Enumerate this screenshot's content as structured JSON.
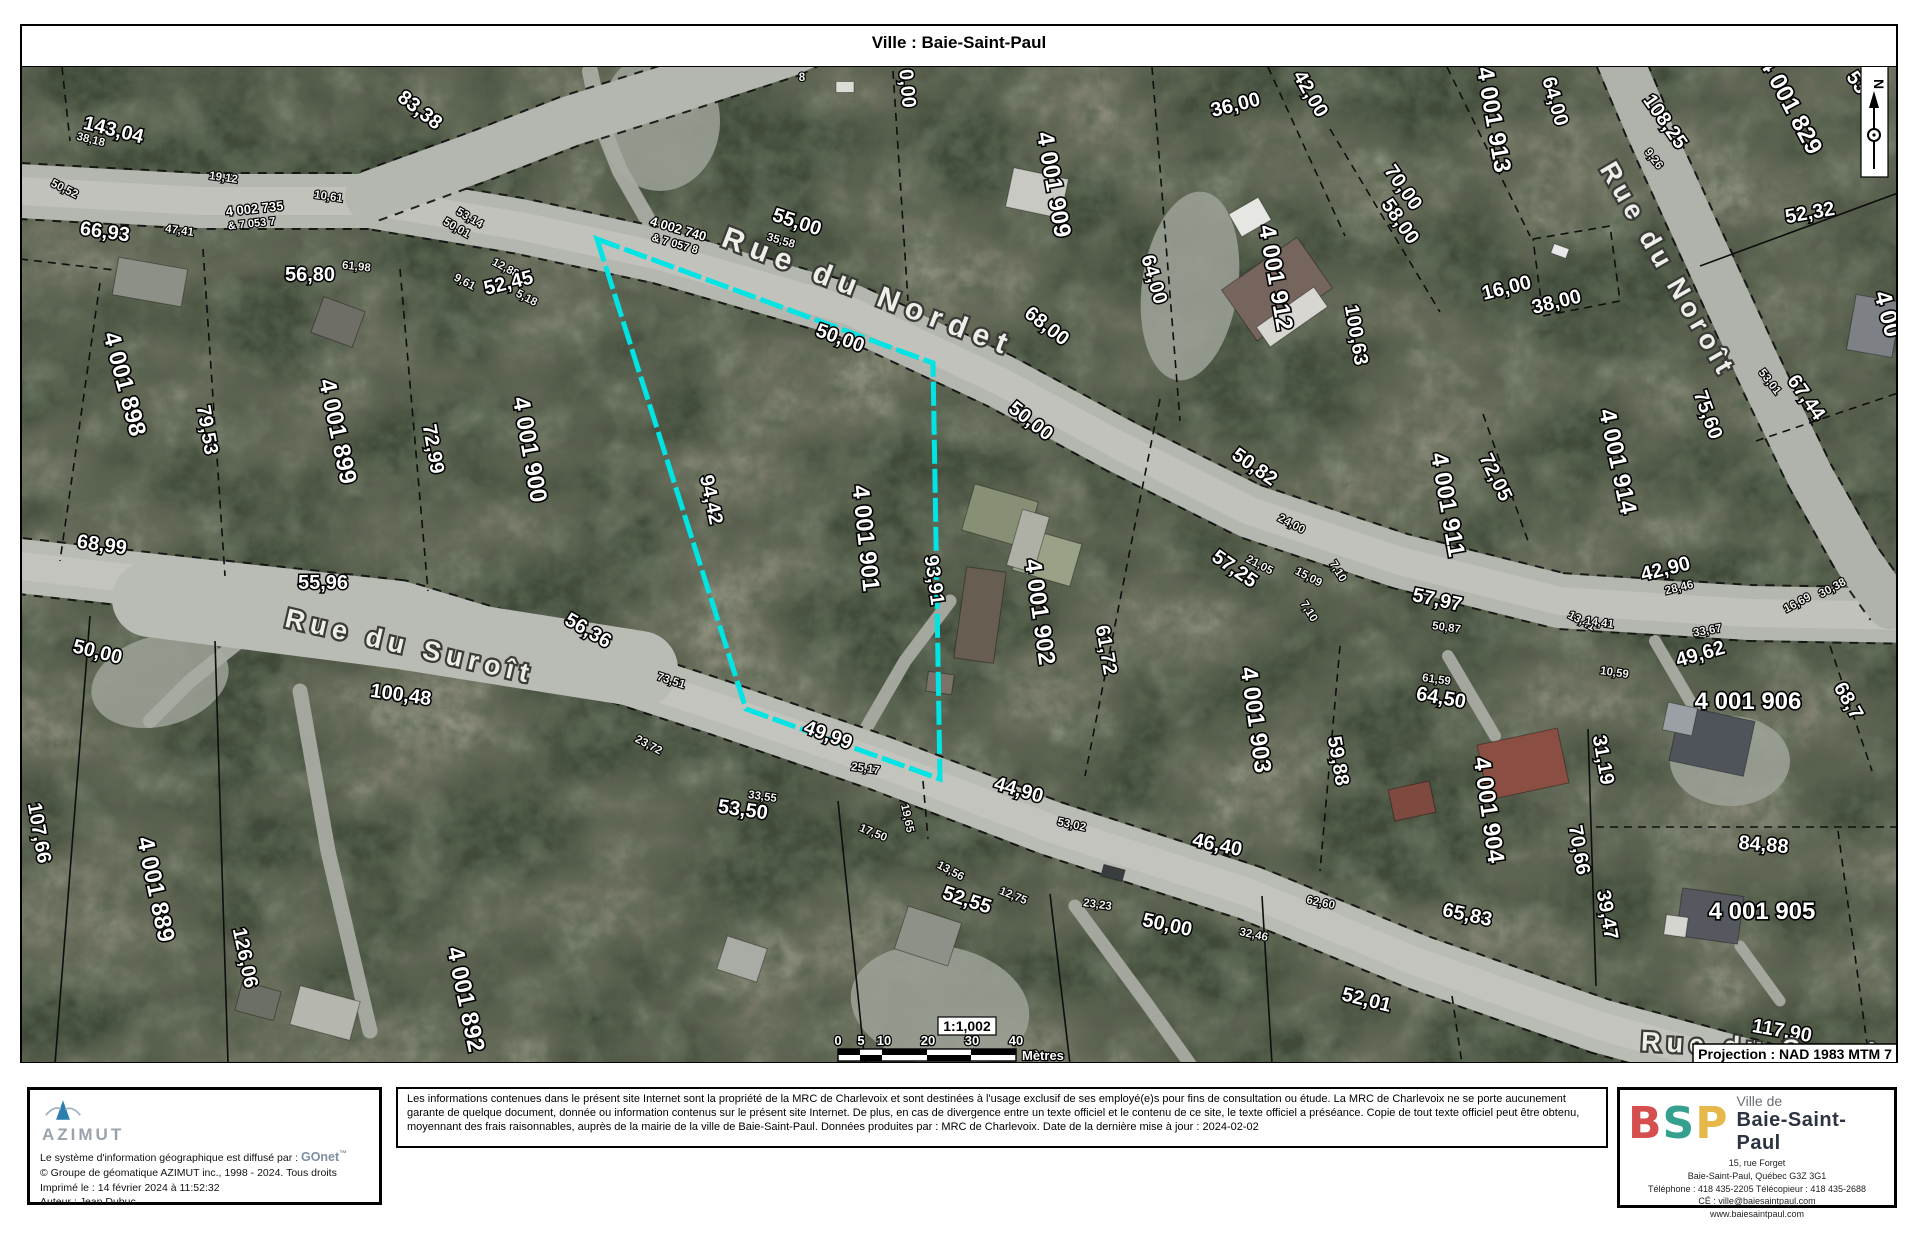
{
  "title": "Ville : Baie-Saint-Paul",
  "map": {
    "projection": "Projection : NAD 1983 MTM 7",
    "north_label": "N",
    "highlight_color": "#00e4e4",
    "parcel": "597,238 933,362 940,778 746,708",
    "scale": {
      "ratio": "1:1,002",
      "unit": "Mètres",
      "ticks": [
        {
          "t": "0",
          "x": 838
        },
        {
          "t": "5",
          "x": 861
        },
        {
          "t": "10",
          "x": 884
        },
        {
          "t": "20",
          "x": 928
        },
        {
          "t": "30",
          "x": 972
        },
        {
          "t": "40",
          "x": 1016
        }
      ],
      "seg": [
        [
          838,
          860
        ],
        [
          860,
          882
        ],
        [
          882,
          927
        ],
        [
          927,
          971
        ],
        [
          971,
          1016
        ]
      ]
    },
    "streets": [
      [
        "Rue du Nordet",
        865,
        300,
        21,
        30,
        8
      ],
      [
        "Rue du Suroît",
        408,
        654,
        13,
        27,
        6
      ],
      [
        "Rue du Noroît",
        1660,
        273,
        60,
        27,
        5
      ],
      [
        "Rue du Suroît",
        1768,
        1056,
        3,
        27,
        6
      ]
    ],
    "lots": [
      [
        "4 001 898",
        117,
        385,
        75
      ],
      [
        "4 001 899",
        330,
        432,
        78
      ],
      [
        "4 001 900",
        522,
        450,
        80
      ],
      [
        "4 001 901",
        858,
        538,
        84
      ],
      [
        "4 001 902",
        1032,
        612,
        82
      ],
      [
        "4 001 903",
        1248,
        720,
        82
      ],
      [
        "4 001 904",
        1481,
        810,
        82
      ],
      [
        "4 001 905",
        1762,
        918,
        0
      ],
      [
        "4 001 906",
        1748,
        708,
        0
      ],
      [
        "4 001 909",
        1046,
        185,
        80
      ],
      [
        "4 001 911",
        1440,
        505,
        80
      ],
      [
        "4 001 912",
        1268,
        278,
        80
      ],
      [
        "4 001 913",
        1486,
        120,
        80
      ],
      [
        "4 001 914",
        1610,
        462,
        78
      ],
      [
        "4 001 829",
        1784,
        108,
        62
      ],
      [
        "4 001 889",
        148,
        890,
        78
      ],
      [
        "4 001 892",
        458,
        1000,
        78
      ],
      [
        "4 00",
        1880,
        315,
        75
      ]
    ],
    "roadlots": [
      [
        "4 002 735",
        255,
        212,
        -6,
        13
      ],
      [
        "& 7 053 7",
        252,
        226,
        -6,
        11
      ],
      [
        "4 002 740",
        677,
        232,
        16,
        13
      ],
      [
        "& 7 057 8",
        674,
        246,
        16,
        11
      ]
    ],
    "dims": [
      [
        "143,04",
        112,
        135,
        14
      ],
      [
        "66,93",
        104,
        237,
        8
      ],
      [
        "83,38",
        416,
        114,
        38
      ],
      [
        "56,80",
        310,
        280,
        0
      ],
      [
        "52,45",
        510,
        288,
        -14
      ],
      [
        "55,00",
        795,
        227,
        18
      ],
      [
        "50,00",
        838,
        343,
        20
      ],
      [
        "68,00",
        1043,
        330,
        38
      ],
      [
        "50,00",
        1027,
        425,
        38
      ],
      [
        "0,00",
        901,
        88,
        85
      ],
      [
        "36,00",
        1237,
        110,
        -14
      ],
      [
        "42,00",
        1305,
        96,
        60
      ],
      [
        "64,00",
        1549,
        102,
        74
      ],
      [
        "64,00",
        1148,
        280,
        74
      ],
      [
        "70,00",
        1398,
        190,
        55
      ],
      [
        "58,00",
        1395,
        224,
        55
      ],
      [
        "100,63",
        1350,
        335,
        80
      ],
      [
        "16,00",
        1508,
        293,
        -14
      ],
      [
        "38,00",
        1558,
        307,
        -14
      ],
      [
        "108,25",
        1660,
        124,
        55
      ],
      [
        "52,32",
        1811,
        218,
        -10
      ],
      [
        "53",
        1852,
        85,
        55,
        16
      ],
      [
        "67,44",
        1801,
        400,
        55
      ],
      [
        "75,60",
        1702,
        416,
        70
      ],
      [
        "94,42",
        705,
        500,
        78
      ],
      [
        "93,91",
        928,
        580,
        82
      ],
      [
        "49,99",
        826,
        740,
        20
      ],
      [
        "61,72",
        1100,
        650,
        80
      ],
      [
        "44,90",
        1017,
        795,
        16
      ],
      [
        "53,50",
        742,
        815,
        8
      ],
      [
        "52,55",
        965,
        905,
        18
      ],
      [
        "50,00",
        1166,
        930,
        12
      ],
      [
        "46,40",
        1216,
        850,
        12
      ],
      [
        "52,01",
        1365,
        1005,
        14
      ],
      [
        "117,90",
        1781,
        1036,
        10
      ],
      [
        "50,00",
        96,
        657,
        14
      ],
      [
        "68,99",
        101,
        550,
        8
      ],
      [
        "55,96",
        323,
        588,
        0
      ],
      [
        "56,36",
        585,
        635,
        30
      ],
      [
        "100,48",
        400,
        700,
        8
      ],
      [
        "107,66",
        33,
        833,
        80
      ],
      [
        "126,06",
        239,
        958,
        78
      ],
      [
        "79,53",
        201,
        430,
        80
      ],
      [
        "72,99",
        427,
        449,
        80
      ],
      [
        "72,05",
        1490,
        479,
        64
      ],
      [
        "57,25",
        1231,
        573,
        35
      ],
      [
        "50,82",
        1251,
        471,
        35
      ],
      [
        "57,97",
        1436,
        605,
        12
      ],
      [
        "64,50",
        1440,
        703,
        10
      ],
      [
        "59,88",
        1332,
        761,
        80
      ],
      [
        "31,19",
        1597,
        760,
        80
      ],
      [
        "70,66",
        1573,
        850,
        80
      ],
      [
        "39,47",
        1601,
        915,
        80
      ],
      [
        "65,83",
        1466,
        920,
        12
      ],
      [
        "84,88",
        1763,
        850,
        5
      ],
      [
        "49,62",
        1702,
        659,
        -16
      ],
      [
        "42,90",
        1667,
        574,
        -14
      ],
      [
        "68,7",
        1843,
        703,
        60
      ]
    ],
    "tiny": [
      [
        "38,18",
        90,
        142,
        14
      ],
      [
        "50,52",
        63,
        191,
        26
      ],
      [
        "19,12",
        223,
        180,
        8
      ],
      [
        "10,61",
        328,
        199,
        8
      ],
      [
        "47,41",
        179,
        233,
        8
      ],
      [
        "61,98",
        356,
        269,
        6
      ],
      [
        "53,14",
        468,
        220,
        30
      ],
      [
        "50,01",
        455,
        230,
        30
      ],
      [
        "9,61",
        463,
        284,
        28
      ],
      [
        "12,88",
        504,
        270,
        28
      ],
      [
        "5,18",
        525,
        300,
        28
      ],
      [
        "35,58",
        780,
        243,
        16
      ],
      [
        "8",
        802,
        80,
        0
      ],
      [
        "23,72",
        647,
        747,
        28
      ],
      [
        "73,51",
        670,
        683,
        18
      ],
      [
        "33,55",
        762,
        799,
        8
      ],
      [
        "25,17",
        865,
        771,
        8
      ],
      [
        "19,65",
        904,
        818,
        78
      ],
      [
        "17,50",
        872,
        835,
        22
      ],
      [
        "13,56",
        949,
        873,
        28
      ],
      [
        "12,75",
        1012,
        898,
        22
      ],
      [
        "23,23",
        1097,
        907,
        8
      ],
      [
        "53,02",
        1071,
        827,
        12
      ],
      [
        "62,60",
        1320,
        905,
        12
      ],
      [
        "32,46",
        1253,
        937,
        12
      ],
      [
        "24,00",
        1290,
        526,
        28
      ],
      [
        "21,05",
        1258,
        567,
        28
      ],
      [
        "15,09",
        1307,
        579,
        28
      ],
      [
        "7,10",
        1335,
        572,
        58
      ],
      [
        "7,10",
        1306,
        612,
        58
      ],
      [
        "50,87",
        1446,
        630,
        8
      ],
      [
        "61,59",
        1436,
        682,
        8
      ],
      [
        "13,41",
        1580,
        623,
        28
      ],
      [
        "28,46",
        1680,
        590,
        -14
      ],
      [
        "14,41",
        1599,
        625,
        8
      ],
      [
        "33,67",
        1708,
        633,
        -10
      ],
      [
        "30,38",
        1834,
        590,
        -28
      ],
      [
        "16,69",
        1799,
        605,
        -28
      ],
      [
        "10,59",
        1614,
        675,
        8
      ],
      [
        "9,26",
        1651,
        160,
        52
      ],
      [
        "53,01",
        1767,
        383,
        52
      ]
    ],
    "roads": [
      {
        "p": "20,190 200,200 370,200 520,225 660,255 850,310 1000,380 1120,445 1250,510 1400,560 1560,600 1750,612 1920,615",
        "w": 54,
        "c": "#b4b7af",
        "s": 1
      },
      {
        "p": "370,195 480,155 570,120 660,92 790,50 830,30",
        "w": 50,
        "c": "#b4b7af"
      },
      {
        "p": "1612,40 1650,130 1700,240 1755,360 1810,475 1858,560 1890,605",
        "w": 46,
        "c": "#afb3ac"
      },
      {
        "p": "20,565 200,585 400,607 560,655 720,707 880,762 1050,827 1250,892 1420,962 1600,1025 1820,1085",
        "w": 54,
        "c": "#b9bcb4",
        "s": 1
      },
      {
        "p": "150,598 400,630 640,668",
        "w": 76,
        "c": "#b9bcb4",
        "nc": 1
      }
    ],
    "driveways": [
      {
        "p": "660,240 620,170 600,120 590,70",
        "w": 16
      },
      {
        "p": "850,755 905,660 950,600",
        "w": 13
      },
      {
        "p": "300,690 328,850 370,1030",
        "w": 15
      },
      {
        "p": "1075,905 1145,1000 1190,1063",
        "w": 13
      },
      {
        "p": "1655,640 1690,700 1700,720",
        "w": 12
      },
      {
        "p": "1448,655 1495,735",
        "w": 12
      },
      {
        "p": "1740,945 1780,1000",
        "w": 11
      },
      {
        "p": "240,640 190,680 150,720",
        "w": 14
      }
    ],
    "clearings": [
      {
        "x": 1190,
        "y": 285,
        "rx": 48,
        "ry": 95,
        "r": 8
      },
      {
        "x": 160,
        "y": 680,
        "rx": 70,
        "ry": 45,
        "r": -15
      },
      {
        "x": 940,
        "y": 1005,
        "rx": 90,
        "ry": 60,
        "r": 10
      },
      {
        "x": 660,
        "y": 120,
        "rx": 60,
        "ry": 70,
        "r": 0
      },
      {
        "x": 1730,
        "y": 760,
        "rx": 60,
        "ry": 45,
        "r": 0
      }
    ],
    "boundaries": [
      {
        "p": "203,248 225,575"
      },
      {
        "p": "400,268 428,590"
      },
      {
        "p": "100,282 60,560"
      },
      {
        "p": "90,615 55,1063",
        "d": 0
      },
      {
        "p": "215,640 228,1063",
        "d": 0
      },
      {
        "p": "838,800 865,1063",
        "d": 0
      },
      {
        "p": "1050,893 1070,1063",
        "d": 0
      },
      {
        "p": "1262,895 1272,1063",
        "d": 0
      },
      {
        "p": "1452,995 1462,1063"
      },
      {
        "p": "923,780 928,838"
      },
      {
        "p": "1160,398 1085,775"
      },
      {
        "p": "1340,645 1320,870"
      },
      {
        "p": "1588,728 1596,985",
        "d": 0
      },
      {
        "p": "1596,826 1900,826"
      },
      {
        "p": "1483,413 1528,540"
      },
      {
        "p": "1152,66 1180,420"
      },
      {
        "p": "1268,66 1345,235"
      },
      {
        "p": "1330,128 1440,311"
      },
      {
        "p": "1700,265 1898,192",
        "d": 0
      },
      {
        "p": "1756,440 1898,392"
      },
      {
        "p": "893,70 908,300"
      },
      {
        "p": "1447,66 1530,235"
      },
      {
        "p": "1830,645 1872,770"
      },
      {
        "p": "20,258 140,272"
      },
      {
        "p": "1533,238 1610,225 1620,300 1543,315 1533,238"
      },
      {
        "p": "1838,830 1868,1050"
      },
      {
        "p": "62,66 70,140"
      }
    ],
    "buildings": [
      {
        "x": 150,
        "y": 281,
        "w": 70,
        "h": 38,
        "r": 10,
        "c": "#8d9086"
      },
      {
        "x": 338,
        "y": 321,
        "w": 44,
        "h": 38,
        "r": 20,
        "c": "#6e6e66"
      },
      {
        "x": 1250,
        "y": 216,
        "w": 34,
        "h": 26,
        "r": -30,
        "c": "#e6e6e2"
      },
      {
        "x": 1277,
        "y": 288,
        "w": 92,
        "h": 62,
        "r": -35,
        "c": "#75655c"
      },
      {
        "x": 1292,
        "y": 316,
        "w": 70,
        "h": 24,
        "r": -35,
        "c": "#d8d6d0"
      },
      {
        "x": 1037,
        "y": 192,
        "w": 56,
        "h": 40,
        "r": 12,
        "c": "#c9c9c3"
      },
      {
        "x": 1000,
        "y": 515,
        "w": 66,
        "h": 48,
        "r": 16,
        "c": "#879075"
      },
      {
        "x": 1047,
        "y": 556,
        "w": 60,
        "h": 44,
        "r": 16,
        "c": "#99a186"
      },
      {
        "x": 1028,
        "y": 540,
        "w": 28,
        "h": 58,
        "r": 16,
        "c": "#aeb0a6"
      },
      {
        "x": 980,
        "y": 614,
        "w": 40,
        "h": 92,
        "r": 8,
        "c": "#675d50"
      },
      {
        "x": 940,
        "y": 682,
        "w": 26,
        "h": 20,
        "r": 8,
        "c": "#7a7268"
      },
      {
        "x": 1523,
        "y": 763,
        "w": 82,
        "h": 56,
        "r": -12,
        "c": "#8a4f42"
      },
      {
        "x": 1412,
        "y": 800,
        "w": 42,
        "h": 32,
        "r": -12,
        "c": "#7e493e"
      },
      {
        "x": 1712,
        "y": 740,
        "w": 76,
        "h": 56,
        "r": 12,
        "c": "#4f545a"
      },
      {
        "x": 1680,
        "y": 718,
        "w": 30,
        "h": 28,
        "r": 12,
        "c": "#9aa0a4"
      },
      {
        "x": 1710,
        "y": 915,
        "w": 62,
        "h": 48,
        "r": 8,
        "c": "#55595f"
      },
      {
        "x": 1676,
        "y": 925,
        "w": 22,
        "h": 20,
        "r": 8,
        "c": "#d5d5d0"
      },
      {
        "x": 928,
        "y": 935,
        "w": 56,
        "h": 45,
        "r": 18,
        "c": "#8d9188"
      },
      {
        "x": 742,
        "y": 958,
        "w": 42,
        "h": 35,
        "r": 18,
        "c": "#a9aca4"
      },
      {
        "x": 325,
        "y": 1012,
        "w": 62,
        "h": 40,
        "r": 15,
        "c": "#b5b7af"
      },
      {
        "x": 258,
        "y": 1000,
        "w": 40,
        "h": 30,
        "r": 15,
        "c": "#6c6f65"
      },
      {
        "x": 1874,
        "y": 325,
        "w": 46,
        "h": 56,
        "r": 10,
        "c": "#7d8186"
      },
      {
        "x": 1560,
        "y": 250,
        "w": 16,
        "h": 10,
        "r": 20,
        "c": "#e8e8e8"
      },
      {
        "x": 845,
        "y": 86,
        "w": 18,
        "h": 11,
        "r": 0,
        "c": "#dcdcd6"
      },
      {
        "x": 1113,
        "y": 872,
        "w": 22,
        "h": 12,
        "r": 15,
        "c": "#3a3d40"
      }
    ]
  },
  "footer": {
    "azimut": {
      "name": "AZIMUT",
      "diffuse_prefix": "Le système d'information géographique est diffusé par : ",
      "gonet": "GOnet",
      "tm": "™",
      "line2": "© Groupe de géomatique AZIMUT inc., 1998 - 2024. Tous droits",
      "line3": "Imprimé le : 14 février 2024 à 11:52:32",
      "line4": "Auteur : Jean Dubuc"
    },
    "disclaimer": "Les informations contenues dans le présent site Internet sont la propriété de la MRC de Charlevoix et sont destinées à l'usage exclusif de ses employé(e)s pour fins de consultation ou étude. La MRC de Charlevoix ne se porte aucunement garante de quelque document, donnée ou information contenus sur le présent site Internet. De plus, en cas de divergence entre un texte officiel et le contenu de ce site, le texte officiel a préséance. Copie de tout texte officiel peut être obtenu, moyennant des frais raisonnables, auprès de la mairie de la ville de Baie-Saint-Paul. Données produites par : MRC de Charlevoix. Date de la dernière mise à jour : 2024-02-02",
    "bsp": {
      "b": "B",
      "s": "S",
      "p": "P",
      "ville_de": "Ville de",
      "city": "Baie-Saint-Paul",
      "addr1": "15, rue Forget",
      "addr2": "Baie-Saint-Paul, Québec G3Z 3G1",
      "addr3": "Téléphone :  418 435-2205 Télécopieur :  418 435-2688",
      "addr4": "CÉ :  ville@baiesaintpaul.com",
      "addr5": "www.baiesaintpaul.com"
    }
  }
}
